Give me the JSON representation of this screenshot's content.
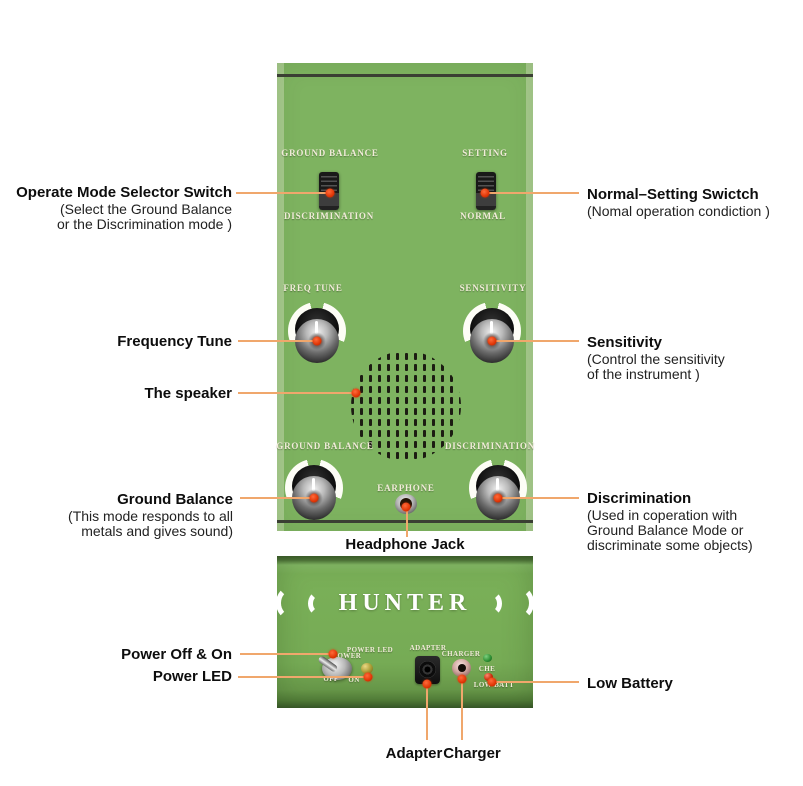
{
  "colors": {
    "panel_green": "#7eb360",
    "panel_green_light": "#a6c98c",
    "panel_edge_dark": "#3a3f33",
    "callout_orange": "#f0a76c",
    "dot_red": "#e03505",
    "label_cream": "#f2ecda"
  },
  "panel": {
    "mode_switch": {
      "top": "GROUND BALANCE",
      "bottom": "DISCRIMINATION"
    },
    "setting_switch": {
      "top": "SETTING",
      "bottom": "NORMAL"
    },
    "knob_freq": "FREQ TUNE",
    "knob_sens": "SENSITIVITY",
    "knob_gb": "GROUND BALANCE",
    "knob_disc": "DISCRIMINATION",
    "earphone": "EARPHONE"
  },
  "lower_panel": {
    "brand": "HUNTER",
    "power": "POWER",
    "power_led": "POWER LED",
    "off": "OFF",
    "on": "ON",
    "adapter": "ADAPTER",
    "charger": "CHARGER",
    "che": "CHE",
    "low_batt": "LOW BATT"
  },
  "annotations": {
    "operate_mode_title": "Operate Mode Selector Switch",
    "operate_mode_line1": "(Select the Ground Balance",
    "operate_mode_line2": "or the Discrimination mode )",
    "frequency_tune": "Frequency Tune",
    "speaker": "The speaker",
    "ground_balance_title": "Ground Balance",
    "ground_balance_line1": "(This mode responds to all",
    "ground_balance_line2": "metals and gives sound)",
    "power_off_on": "Power Off & On",
    "power_led": "Power LED",
    "normal_setting_title": "Normal–Setting Swictch",
    "normal_setting_line1": "(Nomal operation condiction )",
    "sensitivity_title": "Sensitivity",
    "sensitivity_line1": "(Control the sensitivity",
    "sensitivity_line2": "of the instrument )",
    "discrimination_title": "Discrimination",
    "discrimination_line1": "(Used in coperation with",
    "discrimination_line2": "Ground Balance Mode or",
    "discrimination_line3": "discriminate some objects)",
    "low_battery": "Low Battery",
    "headphone_jack": "Headphone Jack",
    "adapter": "Adapter",
    "charger": "Charger"
  }
}
